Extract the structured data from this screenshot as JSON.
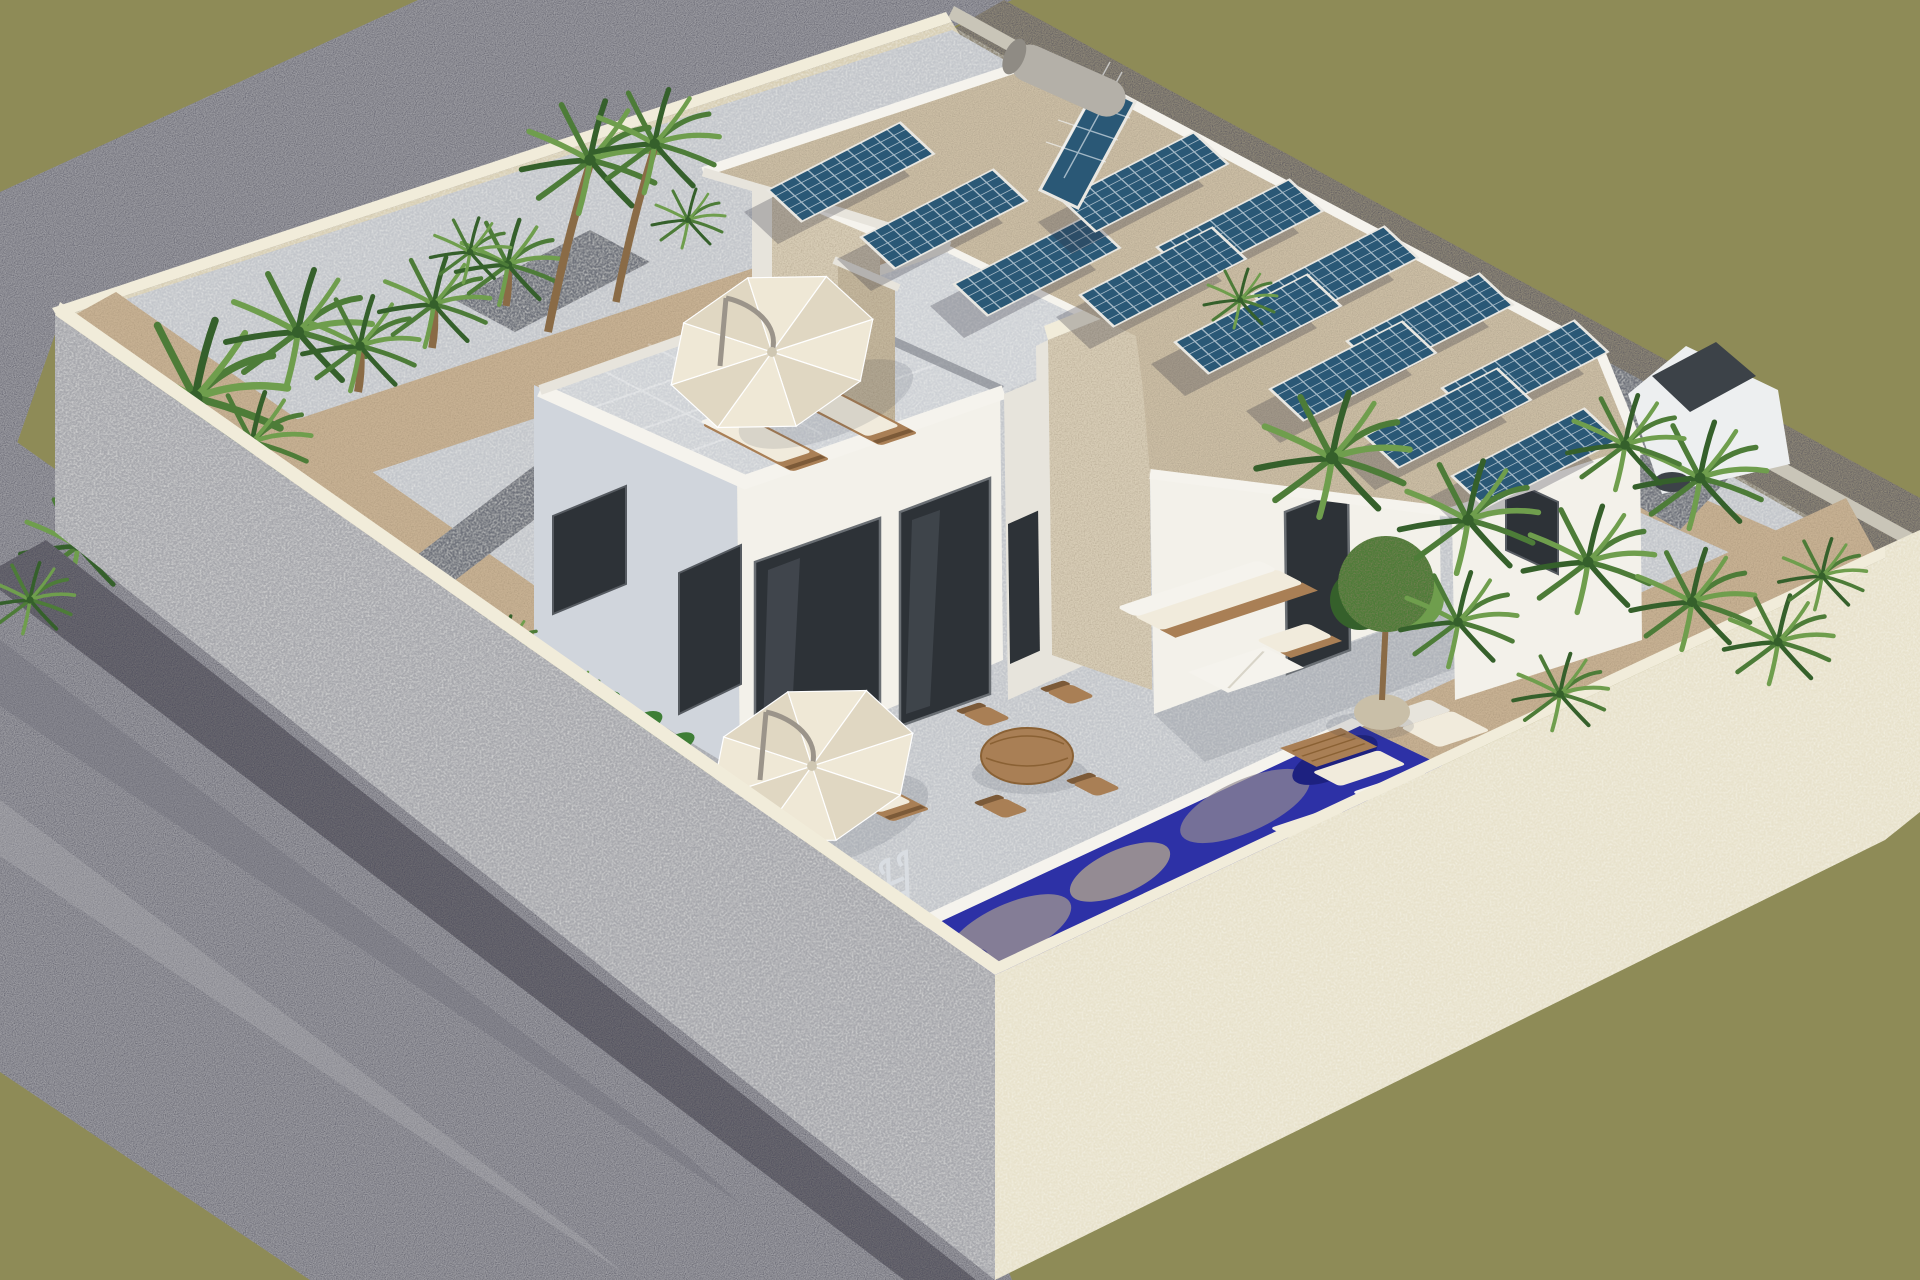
{
  "scene": {
    "title": "Isometric 3D architectural render of a modern villa plot",
    "description": "Bird's-eye isometric rendering of a walled corner plot with a modern white two-volume villa: a flat-roof solar array with thermosiphon water heater on the single-storey wing, a roof terrace with parasol and sun loungers on the two-storey wing, a mosaic-blue plunge pool with chrome ladder, stone feature chimney, outdoor lounge and dining furniture, palm planting beds along cream stone boundary walls, grey gravel verge outside the walls and an olive-green ground plane.",
    "objects": {
      "solar_panels_flat": 13,
      "solar_water_heater_tanks": 1,
      "parasols": 2,
      "wooden_sun_loungers": 4,
      "white_lounge_pads": 3,
      "outdoor_sofas": 1,
      "ottomans": 2,
      "coffee_tables": 2,
      "dining_tables": 1,
      "dining_chairs": 4,
      "potted_trees": 1,
      "pools": 1,
      "pool_ladders": 1,
      "cars": 1,
      "palm_plants": 20,
      "buildings": 2,
      "stone_chimneys": 2
    }
  },
  "colors": {
    "olive": "#8e8b57",
    "gravel": "#9d9da3",
    "gravelShade": "#6f6f78",
    "gravelLight": "#b8b8bd",
    "cobble": "#6c6a71",
    "wallGray": "#a7a8ad",
    "wallCream": "#e8e2cc",
    "wallCap": "#f1ecda",
    "stoneBand": "#8f8878",
    "coping": "#c9c5b8",
    "innerBeige": "#d8cfb5",
    "sand": "#c7b193",
    "paving": "#c3c6cb",
    "pavingLight": "#ced1d6",
    "pathDark": "#70737b",
    "parapet": "#f5f3ed",
    "white": "#f3f1ea",
    "shadeFace": "#d0d5dc",
    "dimWhite": "#e7e4dc",
    "stone": "#d7ccb5",
    "stoneShade": "#c3b69c",
    "pebble": "#cdbfa6",
    "cell": "#2a5876",
    "cellDark": "#1f4a67",
    "frame": "#e9e7e1",
    "glass": "#2d3237",
    "glassLight": "#50565e",
    "wood": "#a97f55",
    "woodDark": "#7c5a38",
    "cushion": "#f1ebdc",
    "canopyA": "#efe8d6",
    "canopyB": "#e0d7c2",
    "umbrellaArm": "#9b948a",
    "pool": "#2d31a6",
    "poolLight": "#4c55c6",
    "poolBlob": "#948b93",
    "poolDark": "#1d2180",
    "green1": "#4d7c38",
    "green2": "#6f9e4d",
    "green3": "#35602b",
    "cover": "#3e7e36",
    "trunk": "#8a6b46",
    "carBody": "#edeff0",
    "carGlass": "#3c4248",
    "chrome": "#d9dde2",
    "pot": "#c9bfa8"
  }
}
